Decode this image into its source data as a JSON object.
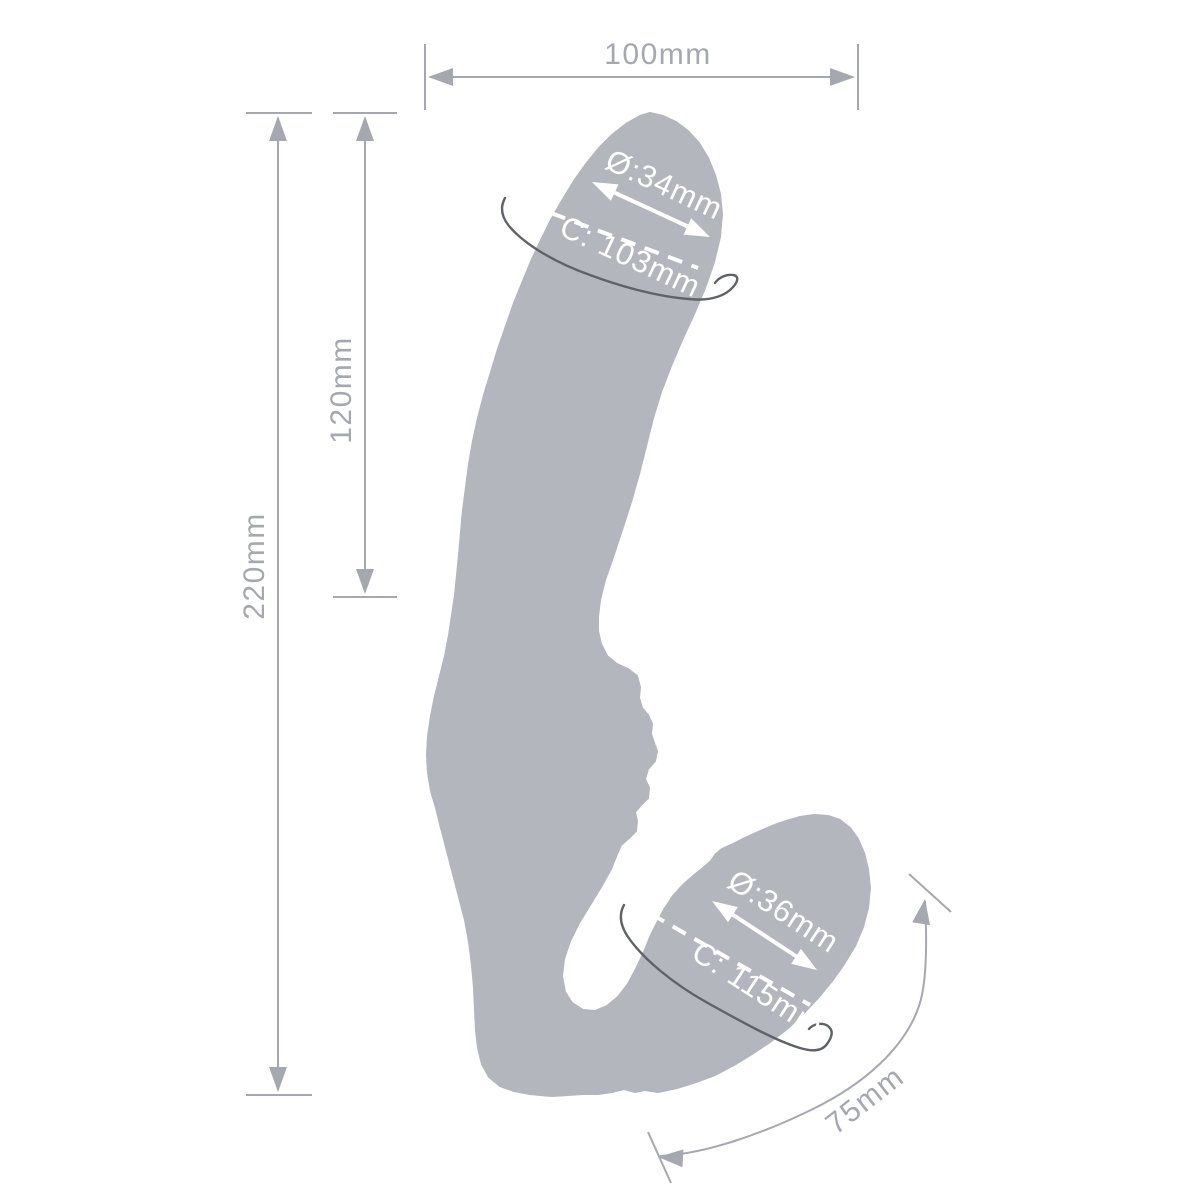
{
  "diagram": {
    "background_color": "#ffffff",
    "silhouette_color": "#b3b6bc",
    "dimension_color": "#a5a8af",
    "girth_arc_color": "#5f6267",
    "overlay_label_color": "#ffffff"
  },
  "measurements": {
    "overall_width": "100mm",
    "total_length": "220mm",
    "insertable_length": "120mm",
    "shaft_diameter": "Ø:34mm",
    "shaft_circumference": "C: 103mm",
    "bulb_diameter": "Ø:36mm",
    "bulb_circumference": "C: 115mm",
    "bulb_length": "75mm"
  }
}
